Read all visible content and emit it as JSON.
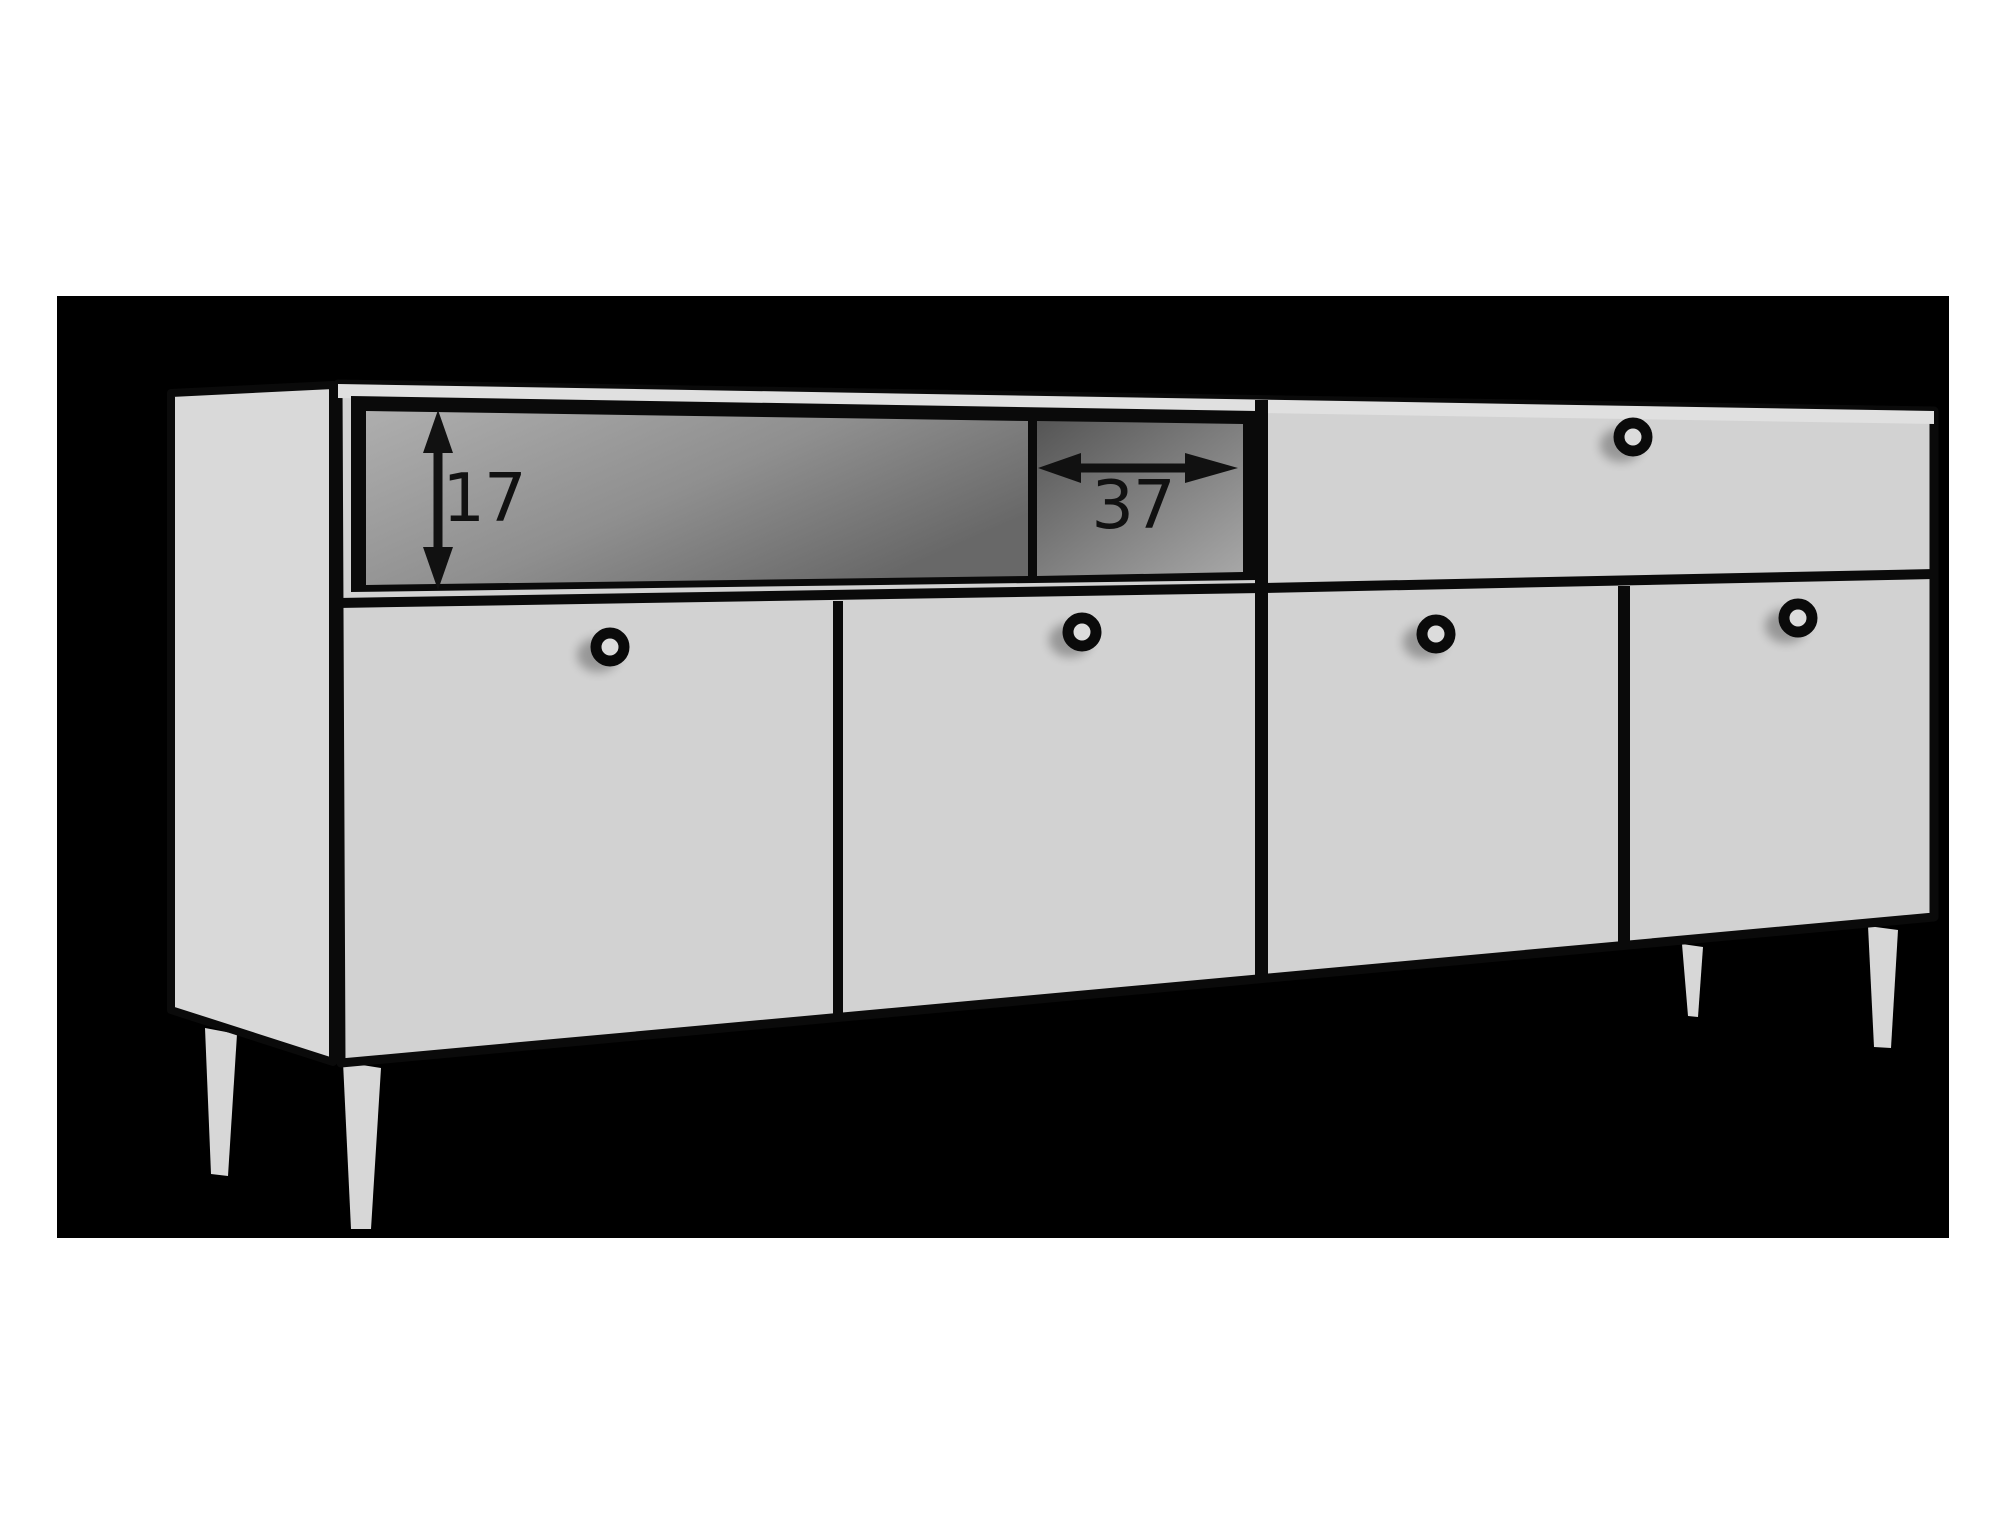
{
  "diagram": {
    "kind": "furniture-dimension-drawing",
    "annotations": {
      "shelf_height": "17",
      "shelf_width": "37"
    },
    "colors": {
      "page": "#ffffff",
      "backdrop": "#000000",
      "outline": "#0a0a0a",
      "ink": "#111111",
      "face": "#d2d2d2",
      "side": "#d9d9d9",
      "top_edge": "#e0e0e0",
      "opening_main_light": "#aeaeae",
      "opening_main_dark": "#686868",
      "opening_small_dark": "#555555",
      "opening_small_light": "#a8a8a8",
      "knob_hole": "#dcdcdc",
      "leg": "#d7d7d7"
    }
  }
}
